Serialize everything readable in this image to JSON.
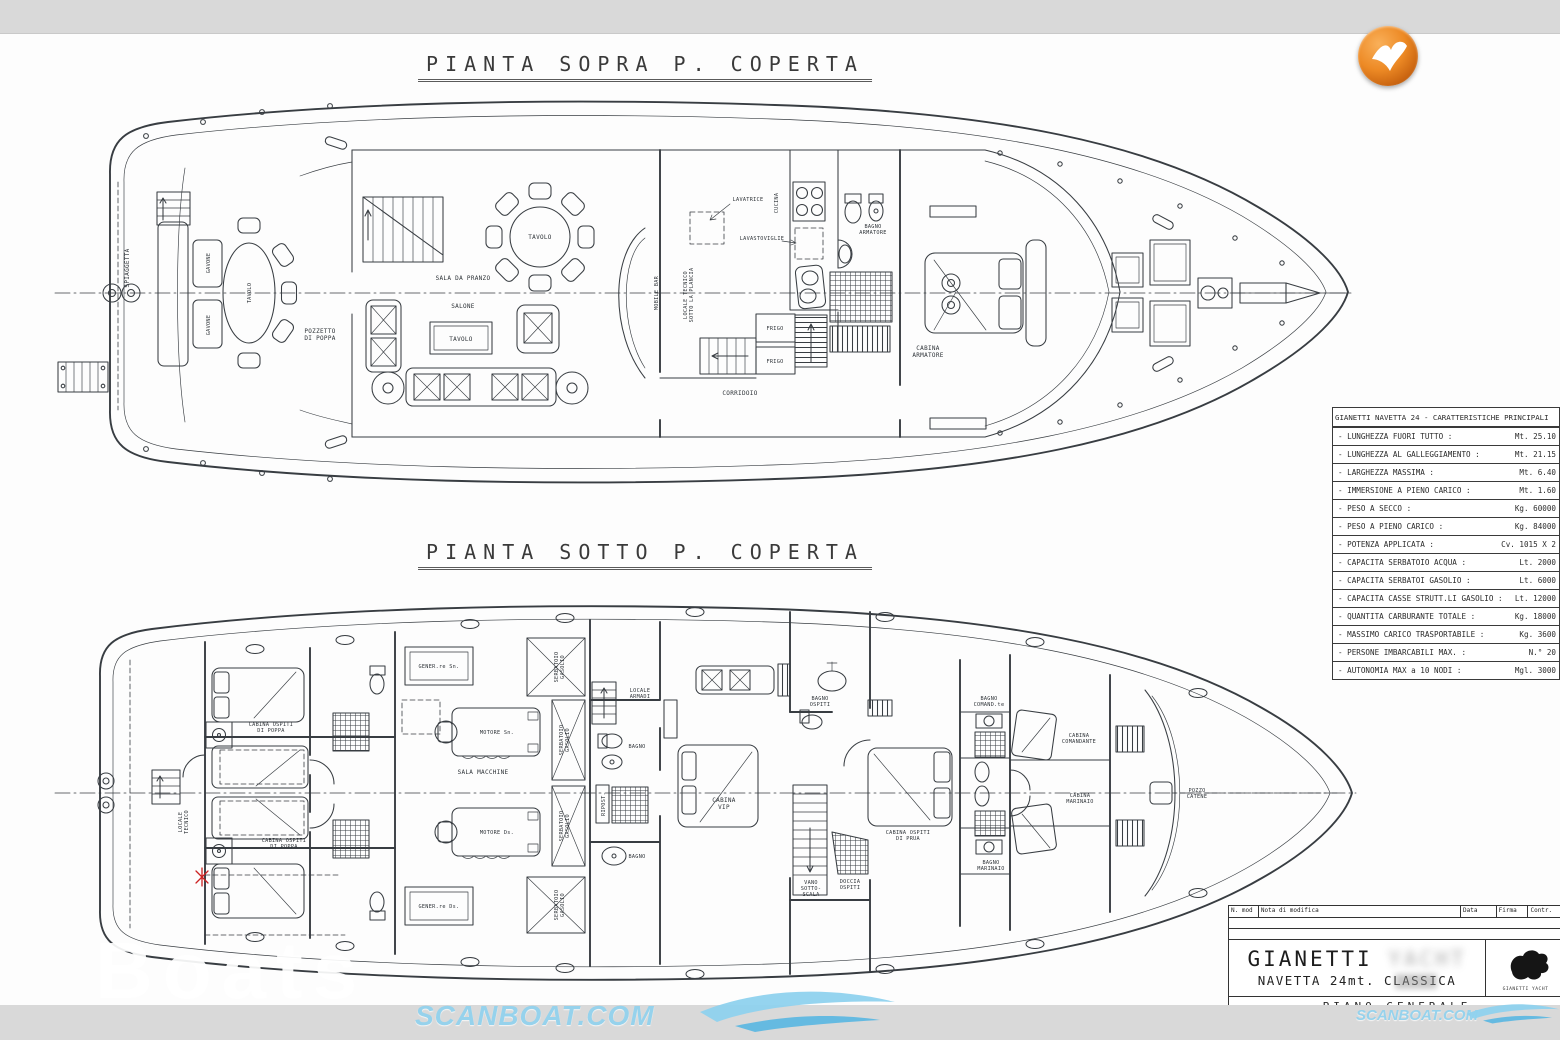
{
  "upper_plan": {
    "title": "PIANTA SOPRA P. COPERTA",
    "labels": {
      "spiaggetta": "SPIAGGETTA",
      "gavone": "GAVONE",
      "tavolo": "TAVOLO",
      "pozzetto": "POZZETTO\nDI POPPA",
      "sala_da_pranzo": "SALA DA PRANZO",
      "salone": "SALONE",
      "mobile_bar": "MOBILE BAR",
      "locale_tecnico_plancia": "LOCALE TECNICO\nSOTTO LA PLANCIA",
      "lavatrice": "LAVATRICE",
      "cucina": "CUCINA",
      "lavastoviglie": "LAVASTOVIGLIE",
      "frigo": "FRIGO",
      "corridoio": "CORRIDOIO",
      "bagno_armatore": "BAGNO\nARMATORE",
      "cabina_armatore": "CABINA\nARMATORE"
    }
  },
  "lower_plan": {
    "title": "PIANTA SOTTO P. COPERTA",
    "labels": {
      "locale_tecnico": "LOCALE\nTECNICO",
      "cabina_ospiti_poppa": "CABINA OSPITI\nDI POPPA",
      "gener_sn": "GENER.re Sn.",
      "gener_ds": "GENER.re Ds.",
      "motore_sn": "MOTORE Sn.",
      "motore_ds": "MOTORE Ds.",
      "sala_macchine": "SALA MACCHINE",
      "serbatoio_gasolio": "SERBATOIO\nGASOLIO",
      "locale_armadi": "LOCALE\nARMADI",
      "bagno": "BAGNO",
      "ripost": "RIPOST.",
      "cabina_vip": "CABINA\nVIP",
      "bagno_ospiti": "BAGNO\nOSPITI",
      "vano_scala": "VANO\nSOTTO-\nSCALA",
      "doccia_ospiti": "DOCCIA\nOSPITI",
      "cabina_ospiti_prua": "CABINA OSPITI\nDI PRUA",
      "bagno_comandante": "BAGNO\nCOMAND.te",
      "bagno_marinaio": "BAGNO\nMARINAIO",
      "cabina_comandante": "CABINA\nCOMANDANTE",
      "cabina_marinaio": "CABINA\nMARINAIO",
      "pozzo_catene": "POZZO\nCATENE"
    }
  },
  "spec_table": {
    "header": "GIANETTI NAVETTA 24 - CARATTERISTICHE PRINCIPALI",
    "rows": [
      {
        "label": "- LUNGHEZZA FUORI TUTTO :",
        "value": "Mt. 25.10"
      },
      {
        "label": "- LUNGHEZZA AL GALLEGGIAMENTO :",
        "value": "Mt. 21.15"
      },
      {
        "label": "- LARGHEZZA MASSIMA :",
        "value": "Mt. 6.40"
      },
      {
        "label": "- IMMERSIONE A PIENO CARICO :",
        "value": "Mt. 1.60"
      },
      {
        "label": "- PESO A SECCO :",
        "value": "Kg. 60000"
      },
      {
        "label": "- PESO A PIENO CARICO :",
        "value": "Kg. 84000"
      },
      {
        "label": "- POTENZA APPLICATA :",
        "value": "Cv. 1015 X 2"
      },
      {
        "label": "- CAPACITA SERBATOIO ACQUA :",
        "value": "Lt. 2000"
      },
      {
        "label": "- CAPACITA SERBATOI GASOLIO :",
        "value": "Lt. 6000"
      },
      {
        "label": "- CAPACITA CASSE STRUTT.LI GASOLIO :",
        "value": "Lt. 12000"
      },
      {
        "label": "- QUANTITA CARBURANTE TOTALE :",
        "value": "Kg. 18000"
      },
      {
        "label": "- MASSIMO CARICO TRASPORTABILE :",
        "value": "Kg. 3600"
      },
      {
        "label": "- PERSONE IMBARCABILI MAX. :",
        "value": "N.° 20"
      },
      {
        "label": "- AUTONOMIA MAX a 10 NODI :",
        "value": "Mgl. 3000"
      }
    ]
  },
  "title_block": {
    "col_n_mod": "N. mod",
    "col_nota": "Nota di modifica",
    "col_data": "Data",
    "col_firma": "Firma",
    "col_contr": "Contr.",
    "maker": "GIANETTI",
    "maker_suffix": "YACHT",
    "model": "NAVETTA 24mt. CLASSICA",
    "drawing_name": "PIANO GENERALE",
    "stamp_caption": "GIANETTI YACHT"
  },
  "watermarks": {
    "ghost": "Boats",
    "scanboat": "SCANBOAT.COM",
    "scanboat_small": "SCANBOAT.COM"
  },
  "colors": {
    "logo_orange": "#ed8a25",
    "watermark_blue": "#96d2ec",
    "band_gray": "#d9d9d9",
    "line_ink": "#383d42",
    "red_mark": "#cc2222"
  }
}
